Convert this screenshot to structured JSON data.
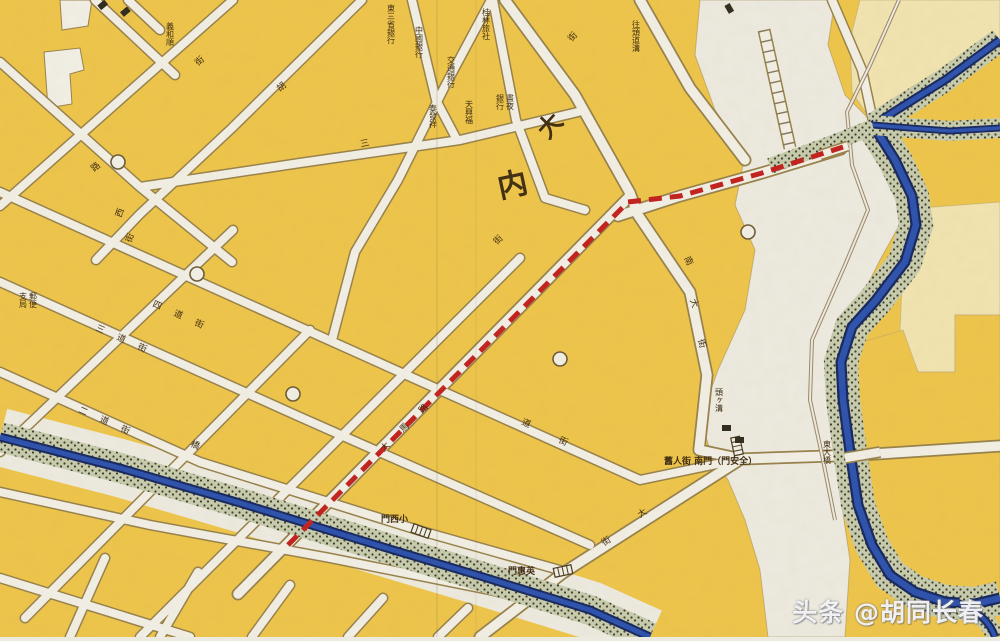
{
  "map": {
    "watermark": {
      "text": "头条 @胡同长春"
    },
    "big_labels": [
      {
        "t": "内",
        "x": 500,
        "y": 198,
        "r": -12,
        "s": 30
      },
      {
        "t": "大",
        "x": 548,
        "y": 140,
        "r": -48,
        "s": 24
      }
    ],
    "street_labels": [
      {
        "t": "街",
        "x": 572,
        "y": 42,
        "r": -50
      },
      {
        "t": "三",
        "x": 361,
        "y": 147,
        "r": -12
      },
      {
        "t": "四道街",
        "x": 152,
        "y": 306,
        "r": 24,
        "ls": 14
      },
      {
        "t": "三道街",
        "x": 95,
        "y": 330,
        "r": 24,
        "ls": 14
      },
      {
        "t": "二道街",
        "x": 78,
        "y": 412,
        "r": 24,
        "ls": 14
      },
      {
        "t": "道",
        "x": 521,
        "y": 424,
        "r": 24
      },
      {
        "t": "街",
        "x": 558,
        "y": 442,
        "r": 24
      },
      {
        "t": "大馬路",
        "x": 384,
        "y": 452,
        "r": -45,
        "ls": 18
      },
      {
        "t": "街",
        "x": 497,
        "y": 245,
        "r": -45
      },
      {
        "t": "南",
        "x": 684,
        "y": 258,
        "r": 65
      },
      {
        "t": "大",
        "x": 690,
        "y": 300,
        "r": 70
      },
      {
        "t": "街",
        "x": 698,
        "y": 340,
        "r": 75
      },
      {
        "t": "西",
        "x": 121,
        "y": 218,
        "r": -70
      },
      {
        "t": "街",
        "x": 131,
        "y": 243,
        "r": -70
      },
      {
        "t": "橋",
        "x": 190,
        "y": 446,
        "r": 22
      },
      {
        "t": "大",
        "x": 640,
        "y": 518,
        "r": -33
      },
      {
        "t": "街",
        "x": 604,
        "y": 546,
        "r": -33
      },
      {
        "t": "街",
        "x": 198,
        "y": 66,
        "r": -40
      },
      {
        "t": "路",
        "x": 94,
        "y": 172,
        "r": -40
      },
      {
        "t": "胡",
        "x": 280,
        "y": 92,
        "r": -42
      }
    ],
    "business_labels": [
      {
        "t": "義和順",
        "x": 170,
        "y": 22
      },
      {
        "t": "東三省銀行",
        "x": 391,
        "y": 4
      },
      {
        "t": "中國銀行",
        "x": 419,
        "y": 26
      },
      {
        "t": "交通銀行",
        "x": 451,
        "y": 56
      },
      {
        "t": "桂林旅社",
        "x": 486,
        "y": 8
      },
      {
        "t": "泰發祥",
        "x": 433,
        "y": 104
      },
      {
        "t": "天興福",
        "x": 469,
        "y": 100
      },
      {
        "t": "晝夜",
        "x": 510,
        "y": 94
      },
      {
        "t": "銀行",
        "x": 500,
        "y": 94
      },
      {
        "t": "郵便",
        "x": 33,
        "y": 292
      },
      {
        "t": "支局",
        "x": 23,
        "y": 292
      },
      {
        "t": "往頭道溝",
        "x": 636,
        "y": 20
      },
      {
        "t": "頭ヶ溝",
        "x": 719,
        "y": 388
      },
      {
        "t": "東大橋",
        "x": 827,
        "y": 440
      }
    ],
    "gate_labels": [
      {
        "t": "門西小",
        "reading": "小西門",
        "x": 381,
        "y": 522
      },
      {
        "t": "門惠英",
        "reading": "英惠門",
        "x": 508,
        "y": 574
      },
      {
        "t": "舊人街 南門（門安全）",
        "reading": "全安門・南門",
        "x": 664,
        "y": 464
      }
    ],
    "route": {
      "name": "highlighted-route",
      "style": "dashed",
      "color": "#c2201d",
      "points": [
        [
          288,
          545
        ],
        [
          628,
          202
        ],
        [
          680,
          196
        ],
        [
          762,
          173
        ],
        [
          843,
          147
        ]
      ]
    },
    "colors": {
      "block_yellow": "#eec54a",
      "pale_yellow": "#f1e4b0",
      "road_white": "#f2efe6",
      "road_casing": "#97814a",
      "floodplain_white": "#edeae0",
      "river_blue": "#2b50ad",
      "river_dark": "#15265e",
      "embankment": "#c7ccae",
      "label_brown": "#3f2c10",
      "route_red": "#c2201d",
      "watermark_white": "#fafafc"
    }
  }
}
